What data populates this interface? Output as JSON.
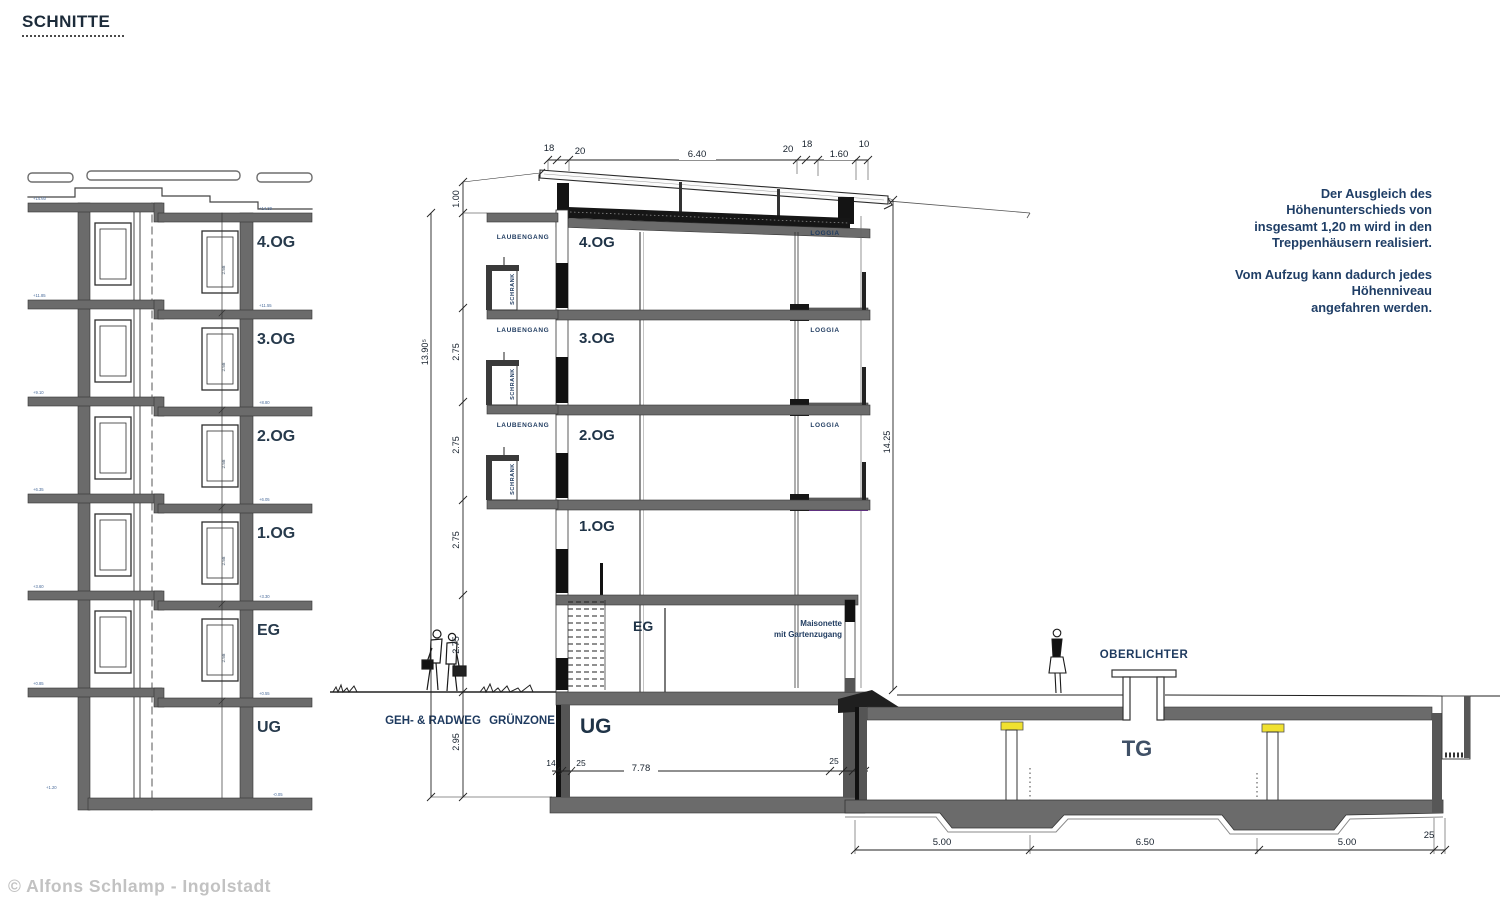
{
  "title": "SCHNITTE",
  "copyright": "© Alfons Schlamp - Ingolstadt",
  "note": {
    "lines": [
      "Der Ausgleich des",
      "Höhenunterschieds von",
      "insgesamt 1,20 m wird in den",
      "Treppenhäusern realisiert.",
      "Vom Aufzug kann dadurch jedes",
      "Höhenniveau",
      "angefahren werden."
    ]
  },
  "left": {
    "floors": [
      "4.OG",
      "3.OG",
      "2.OG",
      "1.OG",
      "EG",
      "UG"
    ],
    "storey_height": "2.58",
    "elev_left": [
      "+14.60",
      "+11.85",
      "+9.10",
      "+6.35",
      "+3.60",
      "+0.85"
    ],
    "elev_left_base": "+1.20",
    "elev_right": [
      "+14.30",
      "+11.55",
      "+8.80",
      "+6.05",
      "+3.30",
      "+0.55"
    ],
    "elev_right_base": "-0.05"
  },
  "mid": {
    "dims_top": [
      "18",
      "20",
      "6.40",
      "20",
      "18",
      "1.60",
      "10"
    ],
    "dim_total": "13.90⁵",
    "dims_left": [
      "1.00",
      "2.75",
      "2.75",
      "2.75",
      "2.75",
      "2.95"
    ],
    "dim_right": "14.25",
    "floors": [
      "4.OG",
      "3.OG",
      "2.OG",
      "1.OG",
      "EG",
      "UG"
    ],
    "laubengang": "LAUBENGANG",
    "schrank": "SCHRANK",
    "loggia": "LOGGIA",
    "maisonette1": "Maisonette",
    "maisonette2": "mit Gartenzugang",
    "ground1": "GEH- & RADWEG",
    "ground2": "GRÜNZONE",
    "dims_bottom": [
      "14",
      "25",
      "7.78",
      "25",
      "12"
    ]
  },
  "tg": {
    "oberlichter": "OBERLICHTER",
    "label": "TG",
    "dims_bottom": [
      "5.00",
      "6.50",
      "5.00",
      "25"
    ]
  },
  "colors": {
    "slab": "#6b6b6b",
    "dark": "#141414",
    "text_navy": "#1e3a5f",
    "accent_yellow": "#f0e130",
    "accent_purple": "#7030a0",
    "copyright_gray": "#c2c2c2"
  }
}
